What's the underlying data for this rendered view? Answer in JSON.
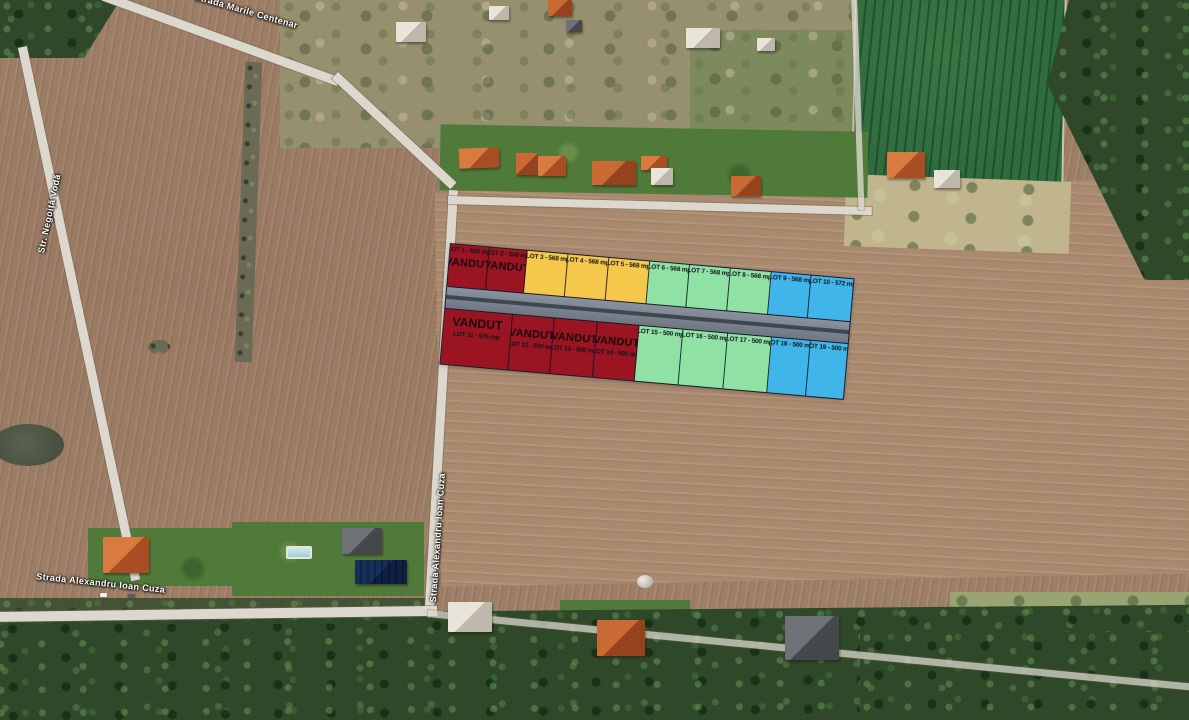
{
  "roads": {
    "top": {
      "name": "Strada Marile Centenar"
    },
    "left": {
      "name": "Str. Negoiță Vodă"
    },
    "vertical": {
      "name": "Strada Alexandru Ioan Cuza"
    },
    "bottom": {
      "name": "Strada Alexandru Ioan Cuza"
    }
  },
  "overlay": {
    "sold_label": "VANDUT",
    "colors": {
      "sold_red": "#9B1421",
      "available_yellow": "#F5C84C",
      "available_green": "#90E2A4",
      "available_blue": "#3FB5E9",
      "road_gray": "#78808C"
    },
    "rows": {
      "row_top": [
        {
          "id": 1,
          "label": "LOT 1 - 500 mp",
          "sold": true,
          "color": "#9B1421",
          "flex": 0.95
        },
        {
          "id": 2,
          "label": "LOT 2 - 500 mp",
          "sold": true,
          "color": "#9B1421",
          "flex": 0.95
        },
        {
          "id": 3,
          "label": "LOT 3 - 568 mp",
          "sold": false,
          "color": "#F5C84C"
        },
        {
          "id": 4,
          "label": "LOT 4 - 568 mp",
          "sold": false,
          "color": "#F5C84C"
        },
        {
          "id": 5,
          "label": "LOT 5 - 568 mp",
          "sold": false,
          "color": "#F5C84C"
        },
        {
          "id": 6,
          "label": "LOT 6 - 568 mp",
          "sold": false,
          "color": "#90E2A4"
        },
        {
          "id": 7,
          "label": "LOT 7 - 568 mp",
          "sold": false,
          "color": "#90E2A4"
        },
        {
          "id": 8,
          "label": "LOT 8 - 568 mp",
          "sold": false,
          "color": "#90E2A4"
        },
        {
          "id": 9,
          "label": "LOT 9 - 568 mp",
          "sold": false,
          "color": "#3FB5E9"
        },
        {
          "id": 10,
          "label": "LOT 10 - 572 mp",
          "sold": false,
          "color": "#3FB5E9",
          "flex": 1.05
        }
      ],
      "row_bottom": [
        {
          "id": 11,
          "label": "LOT 11 - 576 mp",
          "sold": true,
          "color": "#9B1421",
          "flex": 1.7,
          "wide": true
        },
        {
          "id": 12,
          "label": "LOT 12 - 500 mp",
          "sold": true,
          "color": "#9B1421",
          "flex": 1.05
        },
        {
          "id": 13,
          "label": "LOT 13 - 500 mp",
          "sold": true,
          "color": "#9B1421",
          "flex": 1.05
        },
        {
          "id": 14,
          "label": "LOT 14 - 500 mp",
          "sold": true,
          "color": "#9B1421",
          "flex": 1.05
        },
        {
          "id": 15,
          "label": "LOT 15 - 500 mp",
          "sold": false,
          "color": "#90E2A4",
          "flex": 1.1
        },
        {
          "id": 16,
          "label": "LOT 16 - 500 mp",
          "sold": false,
          "color": "#90E2A4",
          "flex": 1.1
        },
        {
          "id": 17,
          "label": "LOT 17 - 500 mp",
          "sold": false,
          "color": "#90E2A4",
          "flex": 1.1
        },
        {
          "id": 18,
          "label": "LOT 18 - 500 mp",
          "sold": false,
          "color": "#3FB5E9",
          "flex": 0.95
        },
        {
          "id": 19,
          "label": "LOT 19 - 500 mp",
          "sold": false,
          "color": "#3FB5E9",
          "flex": 0.95
        }
      ]
    }
  }
}
